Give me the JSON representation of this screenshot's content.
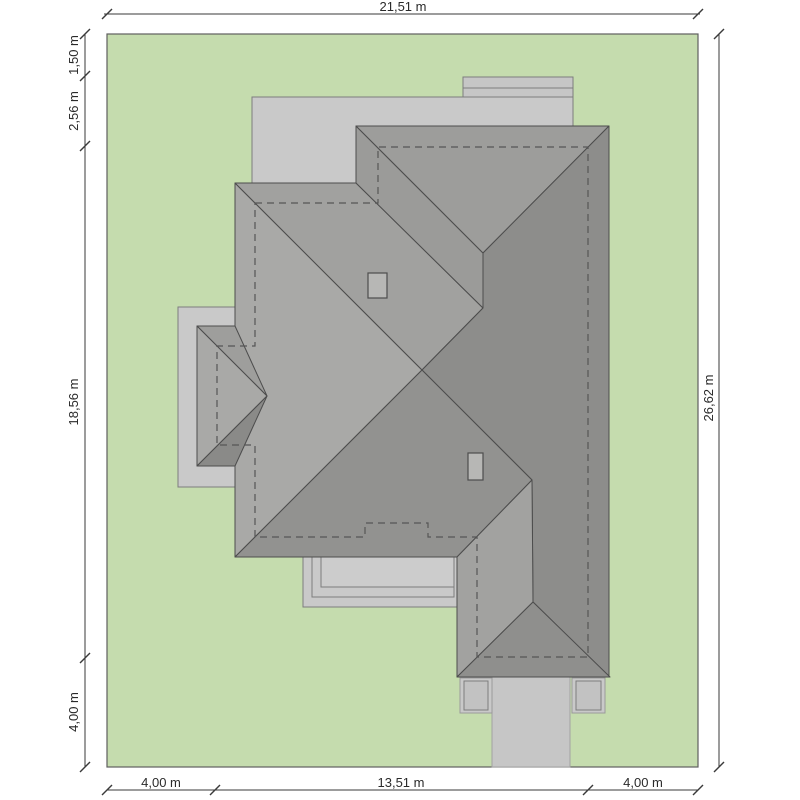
{
  "title": "house-site-plan",
  "dimensions": {
    "plot_width_label": "21,51 m",
    "plot_height_label": "26,62 m",
    "left_segments": [
      "1,50 m",
      "2,56 m",
      "18,56 m",
      "4,00 m"
    ],
    "bottom_segments": [
      "4,00 m",
      "13,51 m",
      "4,00 m"
    ],
    "top_segments": [
      "21,51 m"
    ],
    "right_segments": [
      "26,62 m"
    ]
  },
  "colors": {
    "page_bg": "#ffffff",
    "plot_green": "#c5dcae",
    "plot_border": "#5f5f5f",
    "terrace_fill": "#c9c9c9",
    "terrace_stroke": "#7d7d7d",
    "driveway_fill": "#c6c6c6",
    "driveway_stroke": "#a2a2a2",
    "roof_stroke": "#4d4d4d",
    "roof_light": "#a9a9a7",
    "roof_midlight": "#a1a19f",
    "roof_mid": "#9b9b99",
    "roof_middark": "#929290",
    "roof_dark": "#8d8d8b",
    "chimney_fill": "#b7b7b5",
    "dashed_stroke": "#565656",
    "dim_line": "#3a3a3a",
    "dim_text": "#2a2a2a"
  },
  "drawing": {
    "viewbox": "0 0 800 800",
    "elements": [
      {
        "kind": "rect",
        "name": "plot-boundary",
        "x": 107,
        "y": 34,
        "w": 591,
        "h": 733,
        "fill": "#c5dcae",
        "stroke": "#5f5f5f",
        "sw": 1.2
      },
      {
        "kind": "rect",
        "name": "top-step",
        "x": 463,
        "y": 77,
        "w": 110,
        "h": 20,
        "fill": "#c6c6c6",
        "stroke": "#7d7d7d",
        "sw": 1
      },
      {
        "kind": "line",
        "name": "top-step-edge",
        "x1": 463,
        "y1": 88,
        "x2": 573,
        "y2": 88,
        "stroke": "#7d7d7d",
        "sw": 1
      },
      {
        "kind": "rect",
        "name": "top-terrace",
        "x": 252,
        "y": 97,
        "w": 321,
        "h": 86,
        "fill": "#c9c9c9",
        "stroke": "#7d7d7d",
        "sw": 1
      },
      {
        "kind": "rect",
        "name": "bay-terrace",
        "x": 178,
        "y": 307,
        "w": 62,
        "h": 180,
        "fill": "#c9c9c9",
        "stroke": "#7d7d7d",
        "sw": 1
      },
      {
        "kind": "rect",
        "name": "bottom-terrace-outer",
        "x": 303,
        "y": 557,
        "w": 154,
        "h": 50,
        "fill": "#c9c9c9",
        "stroke": "#7d7d7d",
        "sw": 1
      },
      {
        "kind": "rect",
        "name": "bottom-terrace-mid",
        "x": 312,
        "y": 557,
        "w": 142,
        "h": 40,
        "fill": "#c9c9c9",
        "stroke": "#7d7d7d",
        "sw": 1
      },
      {
        "kind": "rect",
        "name": "bottom-terrace-inner",
        "x": 321,
        "y": 557,
        "w": 133,
        "h": 30,
        "fill": "#cccccc",
        "stroke": "#7d7d7d",
        "sw": 1
      },
      {
        "kind": "rect",
        "name": "driveway",
        "x": 492,
        "y": 677,
        "w": 78,
        "h": 90,
        "fill": "#c6c6c6",
        "stroke": "#a2a2a2",
        "sw": 1
      },
      {
        "kind": "rect",
        "name": "left-pillar-outer",
        "x": 460,
        "y": 678,
        "w": 32,
        "h": 35,
        "fill": "#c9c9c9",
        "stroke": "#9a9a9a",
        "sw": 1
      },
      {
        "kind": "rect",
        "name": "left-pillar-inner",
        "x": 464,
        "y": 681,
        "w": 24,
        "h": 29,
        "fill": "#c2c2c2",
        "stroke": "#7d7d7d",
        "sw": 1
      },
      {
        "kind": "rect",
        "name": "right-pillar-outer",
        "x": 572,
        "y": 678,
        "w": 33,
        "h": 35,
        "fill": "#c9c9c9",
        "stroke": "#9a9a9a",
        "sw": 1
      },
      {
        "kind": "rect",
        "name": "right-pillar-inner",
        "x": 576,
        "y": 681,
        "w": 25,
        "h": 29,
        "fill": "#c2c2c2",
        "stroke": "#7d7d7d",
        "sw": 1
      },
      {
        "kind": "polygon",
        "name": "roof-left-west-slope",
        "pts": "235,183 422,370 235,557",
        "fill": "#a9a9a7",
        "stroke": "#4d4d4d",
        "sw": 1
      },
      {
        "kind": "polygon",
        "name": "roof-left-north-slope",
        "pts": "235,183 356,183 483,308 422,370",
        "fill": "#a1a19f",
        "stroke": "#4d4d4d",
        "sw": 1
      },
      {
        "kind": "polygon",
        "name": "roof-right-west-slope",
        "pts": "356,126 356,183 483,308 483,253",
        "fill": "#9b9b99",
        "stroke": "#4d4d4d",
        "sw": 1
      },
      {
        "kind": "polygon",
        "name": "roof-right-north-slope",
        "pts": "356,126 609,126 483,253",
        "fill": "#9d9d9b",
        "stroke": "#4d4d4d",
        "sw": 1
      },
      {
        "kind": "polygon",
        "name": "roof-east-slope",
        "pts": "483,253 609,126 609,677 533,602 532,480 422,370 483,308",
        "fill": "#8d8d8b",
        "stroke": "#4d4d4d",
        "sw": 1
      },
      {
        "kind": "polygon",
        "name": "roof-left-south-slope",
        "pts": "422,370 532,480 457,557 235,557",
        "fill": "#929290",
        "stroke": "#4d4d4d",
        "sw": 1
      },
      {
        "kind": "polygon",
        "name": "roof-bottom-west-slope",
        "pts": "532,480 457,557 457,677 533,602",
        "fill": "#a2a2a0",
        "stroke": "#4d4d4d",
        "sw": 1
      },
      {
        "kind": "polygon",
        "name": "roof-bottom-south-slope",
        "pts": "533,602 610,677 457,677",
        "fill": "#8f8f8d",
        "stroke": "#4d4d4d",
        "sw": 1
      },
      {
        "kind": "polygon",
        "name": "bay-roof-top-face",
        "pts": "197,326 235,326 267,396",
        "fill": "#9e9e9c",
        "stroke": "#4d4d4d",
        "sw": 1
      },
      {
        "kind": "polygon",
        "name": "bay-roof-left-face",
        "pts": "197,326 267,396 197,466",
        "fill": "#a9a9a7",
        "stroke": "#4d4d4d",
        "sw": 1
      },
      {
        "kind": "polygon",
        "name": "bay-roof-bottom-face",
        "pts": "197,466 267,396 235,466",
        "fill": "#8a8a88",
        "stroke": "#4d4d4d",
        "sw": 1
      },
      {
        "kind": "rect",
        "name": "chimney-upper",
        "x": 368,
        "y": 273,
        "w": 19,
        "h": 25,
        "fill": "#b7b7b5",
        "stroke": "#4d4d4d",
        "sw": 1.2
      },
      {
        "kind": "rect",
        "name": "chimney-lower",
        "x": 468,
        "y": 453,
        "w": 15,
        "h": 27,
        "fill": "#b7b7b5",
        "stroke": "#4d4d4d",
        "sw": 1.2
      },
      {
        "kind": "path",
        "name": "wall-outline-dashed",
        "d": "M255,203 H378 V147 H588 V657 H477 V537 H428 V523 H365 V537 H255 V445 H217 V346 H255 Z",
        "stroke": "#565656",
        "sw": 1.2,
        "dash": "7 5",
        "fill": "none"
      }
    ],
    "dim_lines": [
      {
        "name": "dim-top",
        "x1": 104,
        "y1": 14,
        "x2": 700,
        "y2": 14,
        "ticks": [
          [
            107,
            14
          ],
          [
            698,
            14
          ]
        ],
        "labels": [
          {
            "text": "21,51 m",
            "x": 403,
            "y": 11,
            "rot": 0
          }
        ]
      },
      {
        "name": "dim-bottom",
        "x1": 107,
        "y1": 790,
        "x2": 698,
        "y2": 790,
        "ticks": [
          [
            107,
            790
          ],
          [
            215,
            790
          ],
          [
            588,
            790
          ],
          [
            698,
            790
          ]
        ],
        "labels": [
          {
            "text": "4,00 m",
            "x": 161,
            "y": 787,
            "rot": 0
          },
          {
            "text": "13,51 m",
            "x": 401,
            "y": 787,
            "rot": 0
          },
          {
            "text": "4,00 m",
            "x": 643,
            "y": 787,
            "rot": 0
          }
        ]
      },
      {
        "name": "dim-left",
        "x1": 85,
        "y1": 34,
        "x2": 85,
        "y2": 767,
        "ticks": [
          [
            85,
            34
          ],
          [
            85,
            76
          ],
          [
            85,
            146
          ],
          [
            85,
            658
          ],
          [
            85,
            767
          ]
        ],
        "labels": [
          {
            "text": "1,50 m",
            "x": 78,
            "y": 55,
            "rot": -90
          },
          {
            "text": "2,56 m",
            "x": 78,
            "y": 111,
            "rot": -90
          },
          {
            "text": "18,56 m",
            "x": 78,
            "y": 402,
            "rot": -90
          },
          {
            "text": "4,00 m",
            "x": 78,
            "y": 712,
            "rot": -90
          }
        ]
      },
      {
        "name": "dim-right",
        "x1": 719,
        "y1": 34,
        "x2": 719,
        "y2": 767,
        "ticks": [
          [
            719,
            34
          ],
          [
            719,
            767
          ]
        ],
        "labels": [
          {
            "text": "26,62 m",
            "x": 713,
            "y": 398,
            "rot": -90
          }
        ]
      }
    ],
    "tick_len": 5,
    "label_font_px": 13
  }
}
